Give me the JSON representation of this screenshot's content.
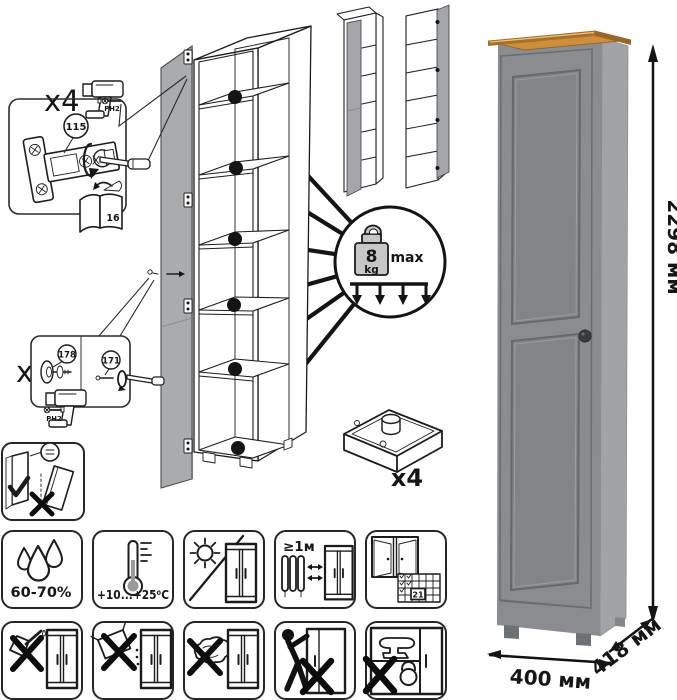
{
  "step_hinges": {
    "count": "x4",
    "part": "115",
    "bit": "PH2",
    "manual_page": "16"
  },
  "step_handle": {
    "count": "x1",
    "part_knob": "178",
    "part_screw": "171",
    "bit": "PH2"
  },
  "weight_limit": {
    "value": "8",
    "unit": "kg",
    "label": "max"
  },
  "feet": {
    "count": "x4"
  },
  "dimensions": {
    "height": "2298 мм",
    "width": "400 мм",
    "depth": "418 мм"
  },
  "care": {
    "humidity": "60-70%",
    "temperature": "+10...+25⁰C",
    "min_distance": "≥1м",
    "calendar_day": "21"
  },
  "icons": {
    "row1": [
      "humidity-icon",
      "temperature-icon",
      "no-direct-sunlight-icon",
      "heat-source-distance-icon",
      "ventilation-icon"
    ],
    "row2": [
      "no-sharp-tools-icon",
      "no-abrasives-icon",
      "no-scouring-icon",
      "no-dragging-icon",
      "no-heavy-load-icon"
    ]
  },
  "colors": {
    "door_gray": "#a9abad",
    "render_front": "#8a8c8f",
    "render_side": "#a1a3a6",
    "wood_top": "#cf8e3c",
    "line": "#1c1c1c"
  }
}
